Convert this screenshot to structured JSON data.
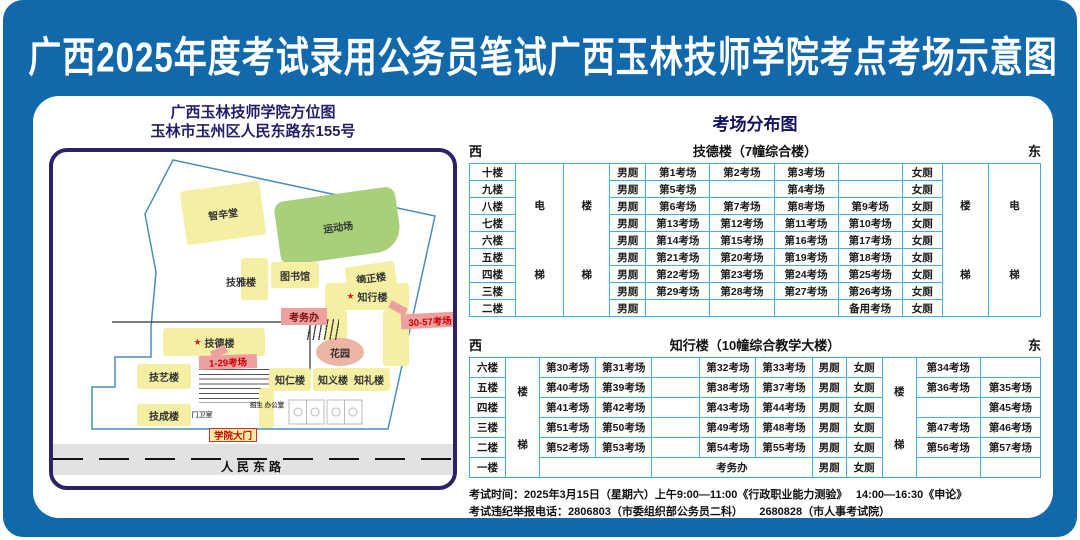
{
  "title": "广西2025年度考试录用公务员笔试广西玉林技师学院考点考场示意图",
  "map": {
    "heading_line1": "广西玉林技师学院方位图",
    "heading_line2": "玉林市玉州区人民东路东155号",
    "star_glyph": "★",
    "buildings": {
      "zhixintang": "智辛堂",
      "sports": "运动场",
      "jiyalou": "技雅楼",
      "library": "图书馆",
      "dezhenglou": "德正楼",
      "zhixinglou": "知行楼",
      "kaowuban": "考务办",
      "rooms_30_57": "30-57考场",
      "jidelou": "技德楼",
      "rooms_1_29": "1-29考场",
      "jiyilou": "技艺楼",
      "zhirenlou": "知仁楼",
      "zhiyilou": "知义楼",
      "zhililou": "知礼楼",
      "garden": "花园",
      "jichenglou": "技成楼",
      "guard_room": "门卫室",
      "admissions_office": "招生 办公室",
      "gate": "学院大门",
      "road": "人民东路"
    }
  },
  "distribution": {
    "title": "考场分布图",
    "tables": [
      {
        "west": "西",
        "east": "东",
        "building_title": "技德楼（7幢综合楼）",
        "row_height": 17,
        "col_widths": [
          46,
          48,
          46,
          36,
          64,
          64,
          64,
          64,
          40,
          46,
          52
        ],
        "left_sides": [
          [
            "电",
            "梯"
          ],
          [
            "楼",
            "梯"
          ]
        ],
        "right_sides": [
          [
            "楼",
            "梯"
          ],
          [
            "电",
            "梯"
          ]
        ],
        "rows": [
          {
            "floor": "十楼",
            "cells": [
              "男厕",
              "第1考场",
              "第2考场",
              "第3考场",
              "",
              "女厕"
            ]
          },
          {
            "floor": "九楼",
            "cells": [
              "男厕",
              "第5考场",
              "",
              "第4考场",
              "",
              "女厕"
            ]
          },
          {
            "floor": "八楼",
            "cells": [
              "男厕",
              "第6考场",
              "第7考场",
              "第8考场",
              "第9考场",
              "女厕"
            ]
          },
          {
            "floor": "七楼",
            "cells": [
              "男厕",
              "第13考场",
              "第12考场",
              "第11考场",
              "第10考场",
              "女厕"
            ]
          },
          {
            "floor": "六楼",
            "cells": [
              "男厕",
              "第14考场",
              "第15考场",
              "第16考场",
              "第17考场",
              "女厕"
            ]
          },
          {
            "floor": "五楼",
            "cells": [
              "男厕",
              "第21考场",
              "第20考场",
              "第19考场",
              "第18考场",
              "女厕"
            ]
          },
          {
            "floor": "四楼",
            "cells": [
              "男厕",
              "第22考场",
              "第23考场",
              "第24考场",
              "第25考场",
              "女厕"
            ]
          },
          {
            "floor": "三楼",
            "cells": [
              "男厕",
              "第29考场",
              "第28考场",
              "第27考场",
              "第26考场",
              "女厕"
            ]
          },
          {
            "floor": "二楼",
            "cells": [
              "男厕",
              "",
              "",
              "",
              "备用考场",
              "女厕"
            ]
          }
        ]
      },
      {
        "west": "西",
        "east": "东",
        "building_title": "知行楼（10幢综合教学大楼）",
        "row_height": 20,
        "col_widths": [
          36,
          34,
          56,
          56,
          48,
          56,
          56,
          34,
          36,
          34,
          64,
          60
        ],
        "left_sides": [
          [
            "楼",
            "梯"
          ]
        ],
        "right_sides": [
          [
            "楼",
            "梯"
          ]
        ],
        "rows": [
          {
            "floor": "六楼",
            "cells": [
              "第30考场",
              "第31考场",
              "",
              "第32考场",
              "第33考场",
              "男厕",
              "女厕"
            ],
            "right": [
              "第34考场",
              ""
            ]
          },
          {
            "floor": "五楼",
            "cells": [
              "第40考场",
              "第39考场",
              "",
              "第38考场",
              "第37考场",
              "男厕",
              "女厕"
            ],
            "right": [
              "第36考场",
              "第35考场"
            ]
          },
          {
            "floor": "四楼",
            "cells": [
              "第41考场",
              "第42考场",
              "",
              "第43考场",
              "第44考场",
              "男厕",
              "女厕"
            ],
            "right": [
              "",
              "第45考场"
            ]
          },
          {
            "floor": "三楼",
            "cells": [
              "第51考场",
              "第50考场",
              "",
              "第49考场",
              "第48考场",
              "男厕",
              "女厕"
            ],
            "right": [
              "第47考场",
              "第46考场"
            ]
          },
          {
            "floor": "二楼",
            "cells": [
              "第52考场",
              "第53考场",
              "",
              "第54考场",
              "第55考场",
              "男厕",
              "女厕"
            ],
            "right": [
              "第56考场",
              "第57考场"
            ]
          },
          {
            "floor": "一楼",
            "cells": [
              {
                "t": "",
                "s": 2
              },
              {
                "t": "考务办",
                "s": 3
              },
              "男厕",
              "女厕"
            ],
            "right": [
              "",
              ""
            ]
          }
        ]
      }
    ]
  },
  "footer": {
    "line1": "考试时间：2025年3月15日（星期六）上午9:00—11:00《行政职业能力测验》　 14:00—16:30《申论》",
    "line2": "考试违纪举报电话：2806803（市委组织部公务员二科）　　2680828（市人事考试院）"
  },
  "colors": {
    "frame_blue": "#1169ac",
    "navy": "#241f66",
    "table_border": "#3fb0dd",
    "building_yellow": "#f4efa3",
    "field_green": "#a8d07a",
    "callout_pink": "#ee9f9f",
    "garden_pink": "#eeb4a4",
    "accent_red": "#cc0000",
    "road_gray": "#e2e2e2"
  }
}
